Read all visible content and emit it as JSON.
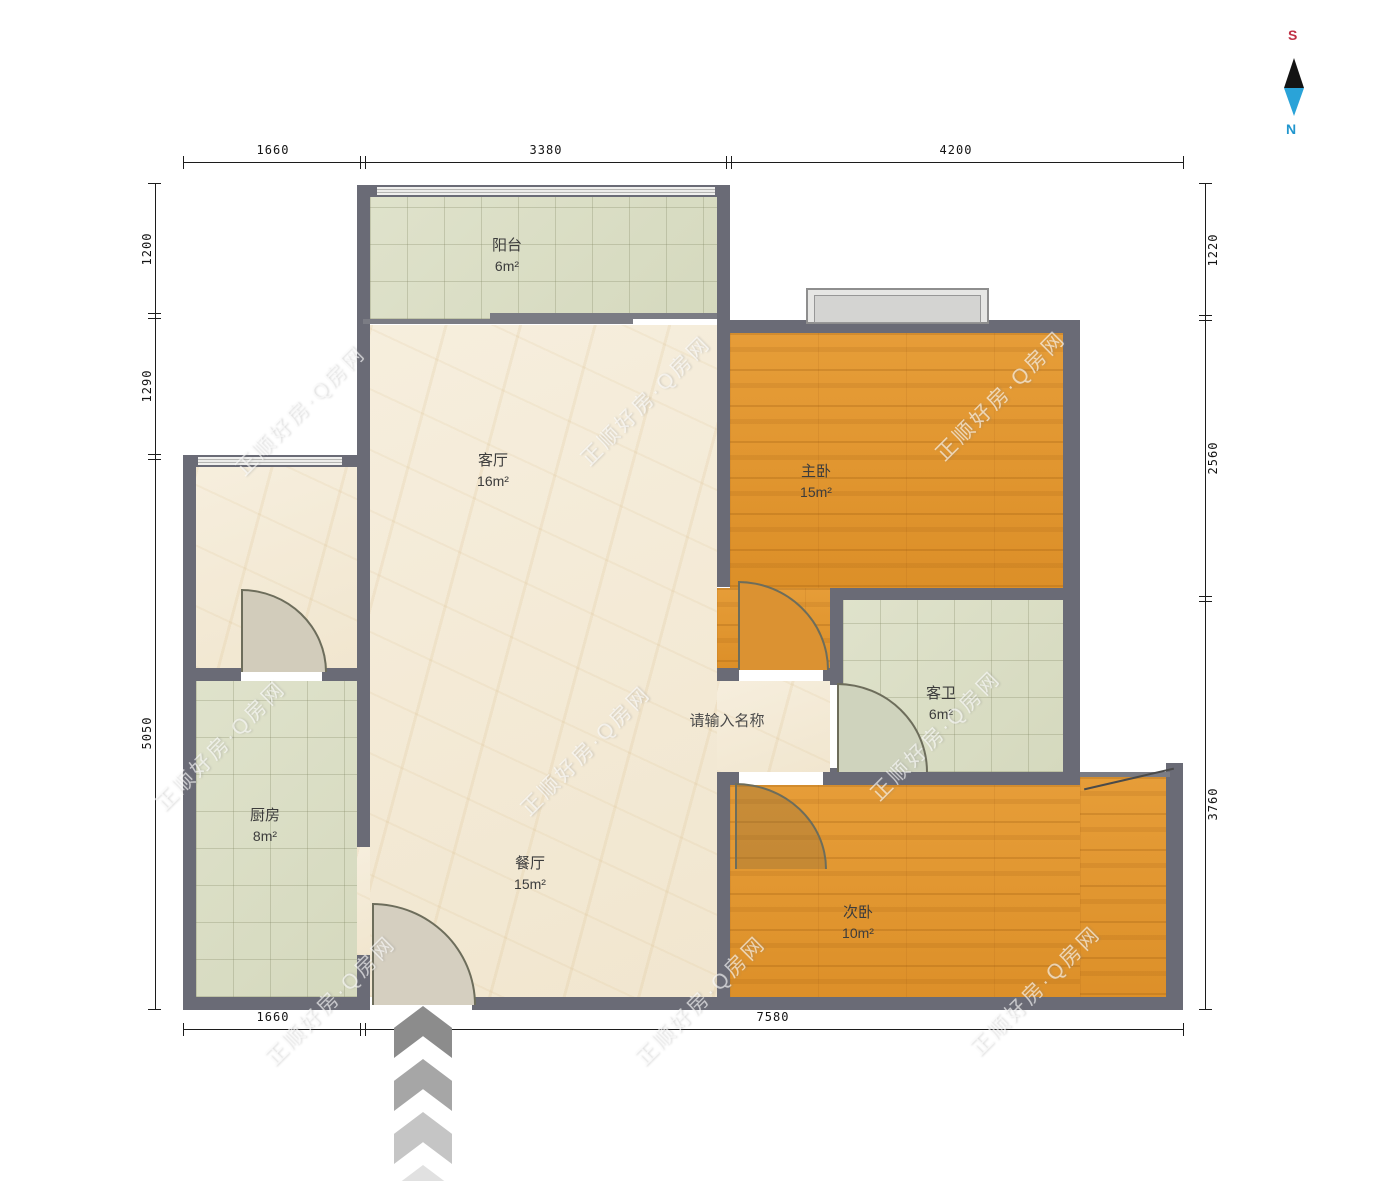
{
  "title": "户型图",
  "placeholder_room_name": "请输入名称",
  "watermark_text": "正顺好房·Q房网",
  "rooms": {
    "balcony": {
      "name": "阳台",
      "area": "6m²"
    },
    "living": {
      "name": "客厅",
      "area": "16m²"
    },
    "master": {
      "name": "主卧",
      "area": "15m²"
    },
    "kitchen": {
      "name": "厨房",
      "area": "8m²"
    },
    "dining": {
      "name": "餐厅",
      "area": "15m²"
    },
    "bath": {
      "name": "客卫",
      "area": "6m²"
    },
    "second": {
      "name": "次卧",
      "area": "10m²"
    }
  },
  "dimensions": {
    "top": [
      "1660",
      "3380",
      "4200"
    ],
    "bottom": [
      "1660",
      "7580"
    ],
    "left": [
      "1200",
      "1290",
      "5050"
    ],
    "right": [
      "1220",
      "2560",
      "3760"
    ]
  },
  "compass": {
    "south": "S",
    "north": "N"
  },
  "colors": {
    "wall": "#6a6b76",
    "wood_floor": "#e0952f",
    "tile_floor": "#dbdfc6",
    "marble_floor": "#f5ecda",
    "south_label": "#c03246",
    "north_label": "#2196ce",
    "compass_blue": "#2aa3d8",
    "compass_black": "#141414"
  }
}
